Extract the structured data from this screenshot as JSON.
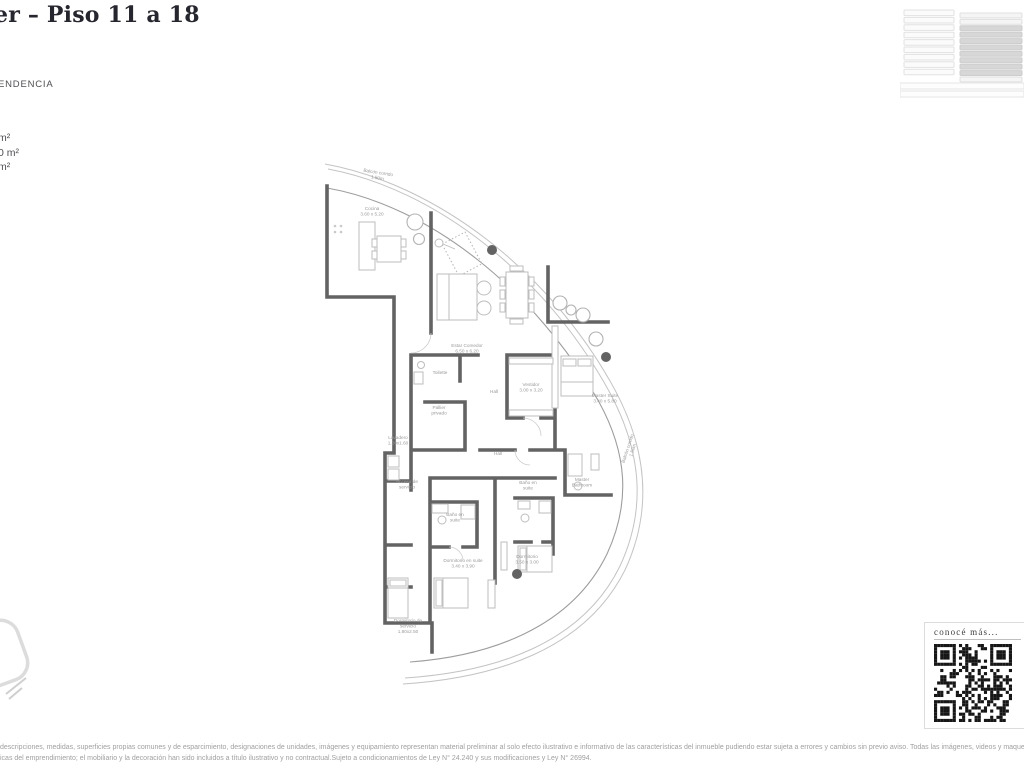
{
  "header": {
    "title_fragment": "er – Piso 11 a 18",
    "subtitle_fragment": "ENDENCIA",
    "area_fragments": [
      "m²",
      "0 m²",
      "m²"
    ]
  },
  "plan": {
    "rooms": [
      {
        "label": "Balcón corrido",
        "dim": "1.50m",
        "x": 63,
        "y": 24,
        "r": 9
      },
      {
        "label": "Cocina",
        "dim": "3.60 x 5.20",
        "x": 57,
        "y": 60
      },
      {
        "label": "Estar Comedor",
        "dim": "6.50 x 6.20",
        "x": 152,
        "y": 197
      },
      {
        "label": "Toilette",
        "x": 125,
        "y": 224
      },
      {
        "label": "Pallier|privado",
        "x": 124,
        "y": 259
      },
      {
        "label": "Hall",
        "x": 179,
        "y": 243
      },
      {
        "label": "Vestidor",
        "dim": "3.00 x 3.20",
        "x": 216,
        "y": 236
      },
      {
        "label": "Master Suite",
        "dim": "3.40 x 5.80",
        "x": 290,
        "y": 247
      },
      {
        "label": "Lavadero",
        "dim": "1.20x1.60",
        "x": 83,
        "y": 289
      },
      {
        "label": "Acceso de|servicio",
        "x": 92,
        "y": 333
      },
      {
        "label": "Hall",
        "x": 183,
        "y": 305
      },
      {
        "label": "Baño en|suite",
        "x": 213,
        "y": 334
      },
      {
        "label": "Master|Bathroom",
        "x": 267,
        "y": 331
      },
      {
        "label": "Baño en|suite",
        "x": 140,
        "y": 366
      },
      {
        "label": "Dormitorio en suite",
        "dim": "3.40 x 3.90",
        "x": 148,
        "y": 412
      },
      {
        "label": "Dormitorio",
        "dim": "3.50 x 3.00",
        "x": 212,
        "y": 408
      },
      {
        "label": "Dormitorio de|servicio",
        "dim": "1.80x2.50",
        "x": 93,
        "y": 472
      },
      {
        "label": "Balcón corrido",
        "dim": "1.50m",
        "x": 314,
        "y": 299,
        "r": -72
      }
    ]
  },
  "qr_card": {
    "caption": "conocé más..."
  },
  "legal": {
    "line1": "descripciones, medidas, superficies propias comunes y de esparcimiento, designaciones de unidades, imágenes y equipamiento representan material preliminar al solo efecto ilustrativo e informativo de las características del inmueble pudiendo estar sujeta a errores y cambios sin previo aviso. Todas las imágenes, videos y maquetas presentadas como material",
    "line2": "icas del emprendimiento; el mobiliario y la decoración han sido incluidos a título ilustrativo y no contractual.Sujeto a condicionamientos de Ley N° 24.240 y sus modificaciones y Ley N° 26994."
  },
  "colors": {
    "wall": "#636363",
    "line": "#c4c4c4",
    "label": "#9a9a9a",
    "title": "#26262e",
    "text": "#4f4f54",
    "legal": "#a0a0a0",
    "qr": "#161616",
    "floor": "#d7d7d7"
  }
}
